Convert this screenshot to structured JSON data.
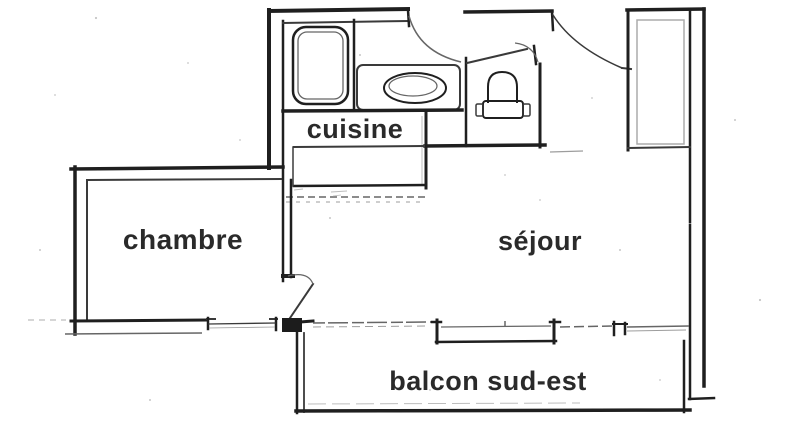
{
  "plan": {
    "rooms": {
      "kitchen": "cuisine",
      "bedroom": "chambre",
      "living_room": "séjour",
      "balcony": "balcon sud-est"
    },
    "fixtures": [
      "bathtub-icon",
      "washbasin-icon",
      "toilet-icon",
      "closet-icon",
      "kitchen-counter-icon",
      "door-arc-icon",
      "window-icon"
    ],
    "colors": {
      "paper": "#ffffff",
      "ink": "#1f1f1f",
      "ink_soft": "#666666",
      "ink_faint": "#9d9d9d",
      "label": "#2a2a2a"
    }
  }
}
